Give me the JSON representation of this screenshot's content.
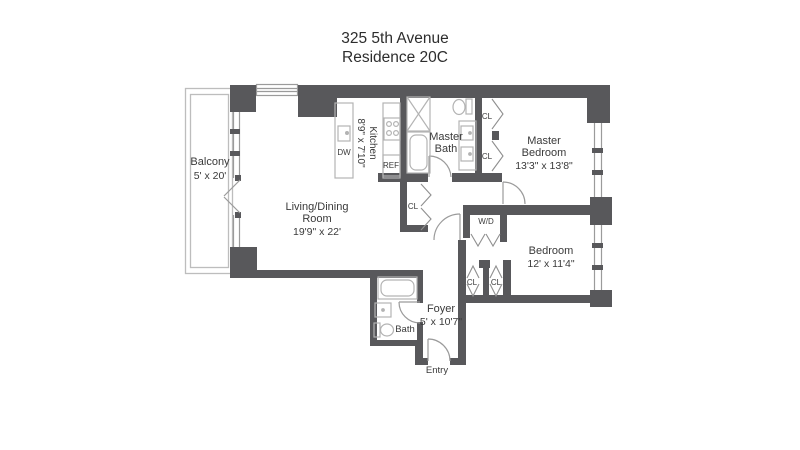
{
  "title": {
    "line1": "325 5th Avenue",
    "line2": "Residence 20C"
  },
  "rooms": {
    "balcony": {
      "name": "Balcony",
      "dims": "5' x 20'"
    },
    "living_dining": {
      "name_line1": "Living/Dining",
      "name_line2": "Room",
      "dims": "19'9\" x 22'"
    },
    "kitchen": {
      "name": "Kitchen",
      "dims": "8'9\" x 7'10\""
    },
    "master_bath": {
      "name_line1": "Master",
      "name_line2": "Bath"
    },
    "master_bedroom": {
      "name_line1": "Master",
      "name_line2": "Bedroom",
      "dims": "13'3\" x 13'8\""
    },
    "bedroom": {
      "name": "Bedroom",
      "dims": "12' x 11'4\""
    },
    "foyer": {
      "name": "Foyer",
      "dims": "5' x 10'7\""
    },
    "bath": {
      "name": "Bath"
    },
    "entry": {
      "name": "Entry"
    },
    "laundry": {
      "name": "W/D"
    }
  },
  "fixtures": {
    "closet": "CL",
    "dishwasher": "DW",
    "refrigerator": "REF"
  },
  "colors": {
    "wall": "#58585b",
    "fixture_line": "#b3b3b3",
    "door_line": "#9b9b9b",
    "text": "#3a3a3a",
    "background": "#ffffff"
  }
}
